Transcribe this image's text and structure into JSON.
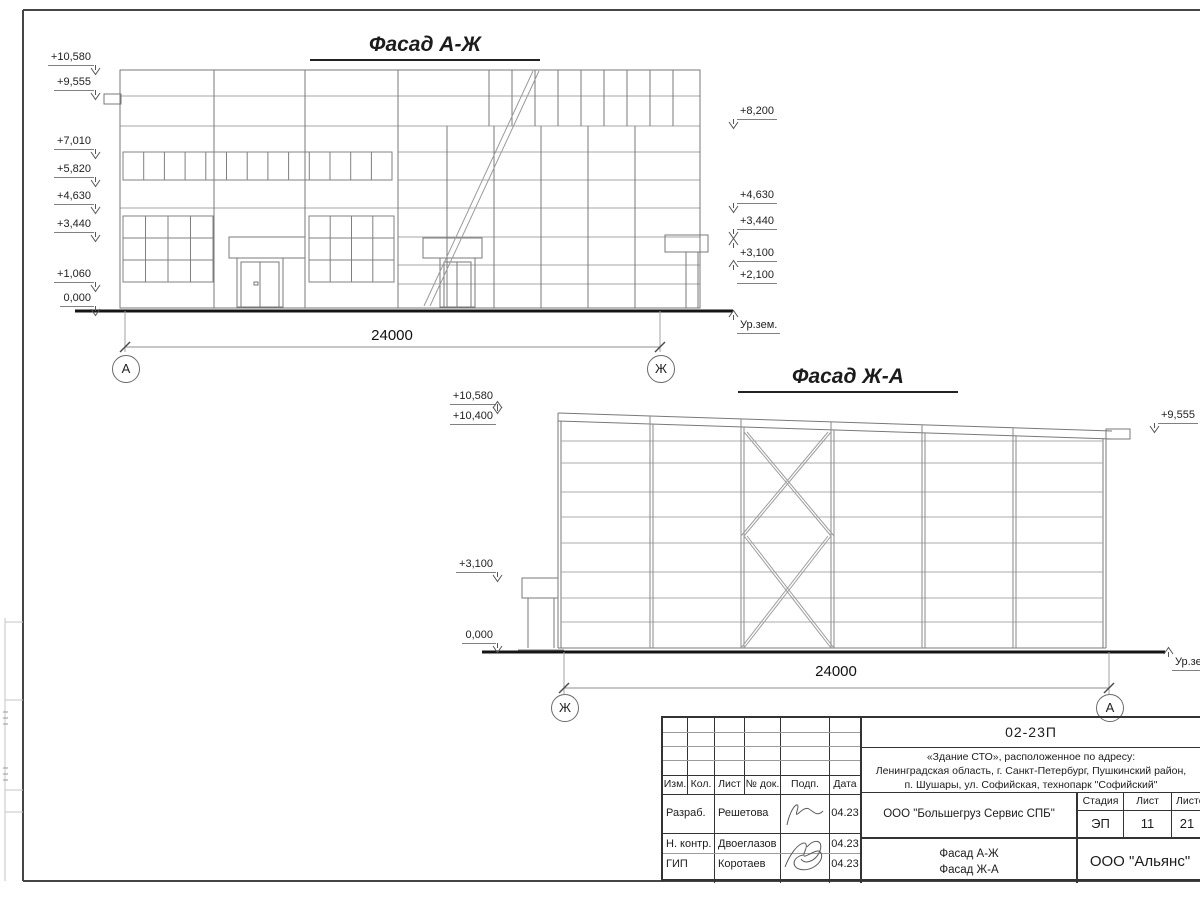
{
  "facade1": {
    "title": "Фасад А-Ж",
    "marks_left": [
      {
        "text": "+10,580"
      },
      {
        "text": "+9,555"
      },
      {
        "text": "+7,010"
      },
      {
        "text": "+5,820"
      },
      {
        "text": "+4,630"
      },
      {
        "text": "+3,440"
      },
      {
        "text": "+1,060"
      },
      {
        "text": "0,000"
      }
    ],
    "marks_right": [
      {
        "text": "+8,200"
      },
      {
        "text": "+4,630"
      },
      {
        "text": "+3,440"
      },
      {
        "text": "+3,100"
      },
      {
        "text": "+2,100"
      }
    ],
    "ground_label": "Ур.зем.",
    "dimension": "24000",
    "axis_left": "А",
    "axis_right": "Ж"
  },
  "facade2": {
    "title": "Фасад Ж-А",
    "marks_left": [
      {
        "text": "+10,580"
      },
      {
        "text": "+10,400"
      },
      {
        "text": "+3,100"
      },
      {
        "text": "0,000"
      }
    ],
    "marks_right": [
      {
        "text": "+9,555"
      }
    ],
    "ground_label": "Ур.зем.",
    "dimension": "24000",
    "axis_left": "Ж",
    "axis_right": "А"
  },
  "stamp": {
    "doc_number": "02-23П",
    "address_line1": "«Здание СТО», расположенное по адресу:",
    "address_line2": "Ленинградская область, г. Санкт-Петербург, Пушкинский район,",
    "address_line3": "п. Шушары, ул. Софийская, технопарк \"Софийский\"",
    "cols": {
      "izm": "Изм.",
      "kol": "Кол.",
      "list": "Лист",
      "doc": "№ док.",
      "podp": "Подп.",
      "data": "Дата"
    },
    "rows": [
      {
        "role": "Разраб.",
        "name": "Решетова",
        "date": "04.23"
      },
      {
        "role": "Н. контр.",
        "name": "Двоеглазов",
        "date": "04.23"
      },
      {
        "role": "ГИП",
        "name": "Коротаев",
        "date": "04.23"
      }
    ],
    "company": "ООО \"Большегруз Сервис СПБ\"",
    "stage_label": "Стадия",
    "sheet_label": "Лист",
    "sheets_label": "Листов",
    "stage": "ЭП",
    "sheet": "11",
    "sheets": "21",
    "content_line1": "Фасад А-Ж",
    "content_line2": "Фасад Ж-А",
    "org": "ООО \"Альянс\""
  }
}
